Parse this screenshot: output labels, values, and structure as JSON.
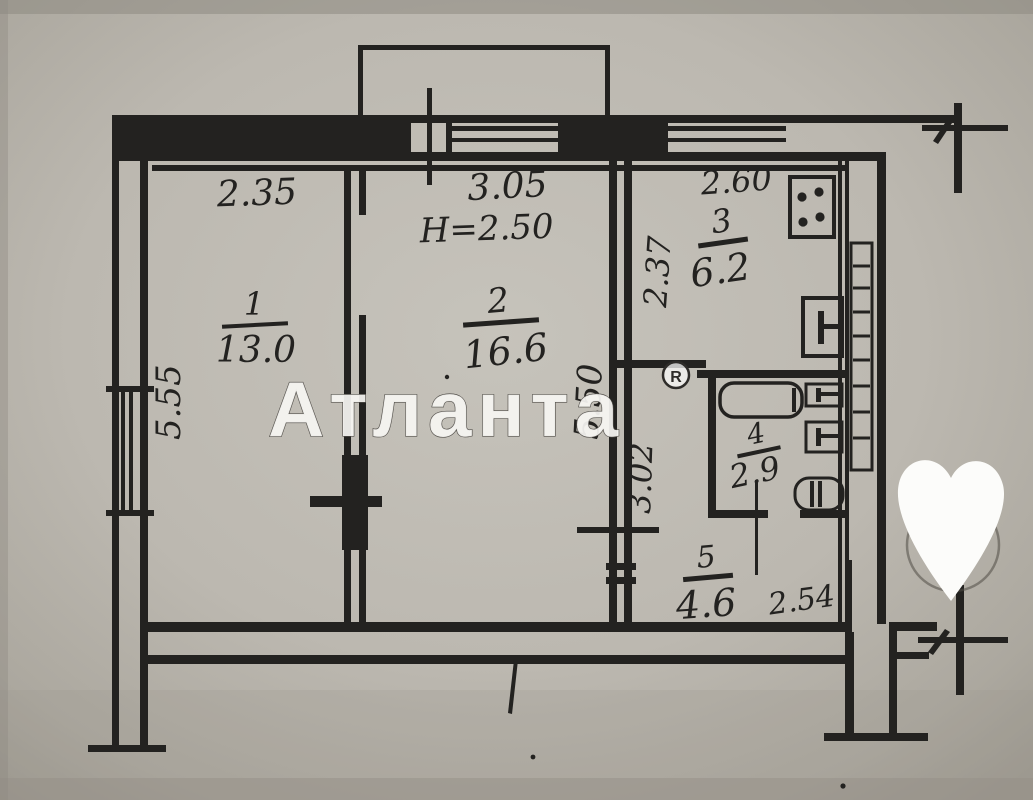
{
  "plan": {
    "kind": "apartment-floor-plan-scan",
    "rooms": {
      "room1": {
        "number": "1",
        "area": "13.0",
        "width": "2.35",
        "depth": "5.55"
      },
      "room2": {
        "number": "2",
        "area": "16.6",
        "width": "3.05",
        "depth": "5.50",
        "ceiling_height": "H=2.50"
      },
      "room3": {
        "number": "3",
        "area": "6.2",
        "width": "2.60",
        "depth": "2.37"
      },
      "room4": {
        "number": "4",
        "area": "2.9"
      },
      "room5": {
        "number": "5",
        "area": "4.6",
        "width": "2.54",
        "depth": "3.02"
      }
    }
  },
  "watermark": {
    "brand": "Атланта",
    "registered": "R"
  },
  "colors": {
    "paper": "#c3c0b8",
    "paper_edge": "#a5a199",
    "ink": "#232220",
    "watermark_fill": "#f6f5f2",
    "sticker": "#fcfcfa"
  }
}
